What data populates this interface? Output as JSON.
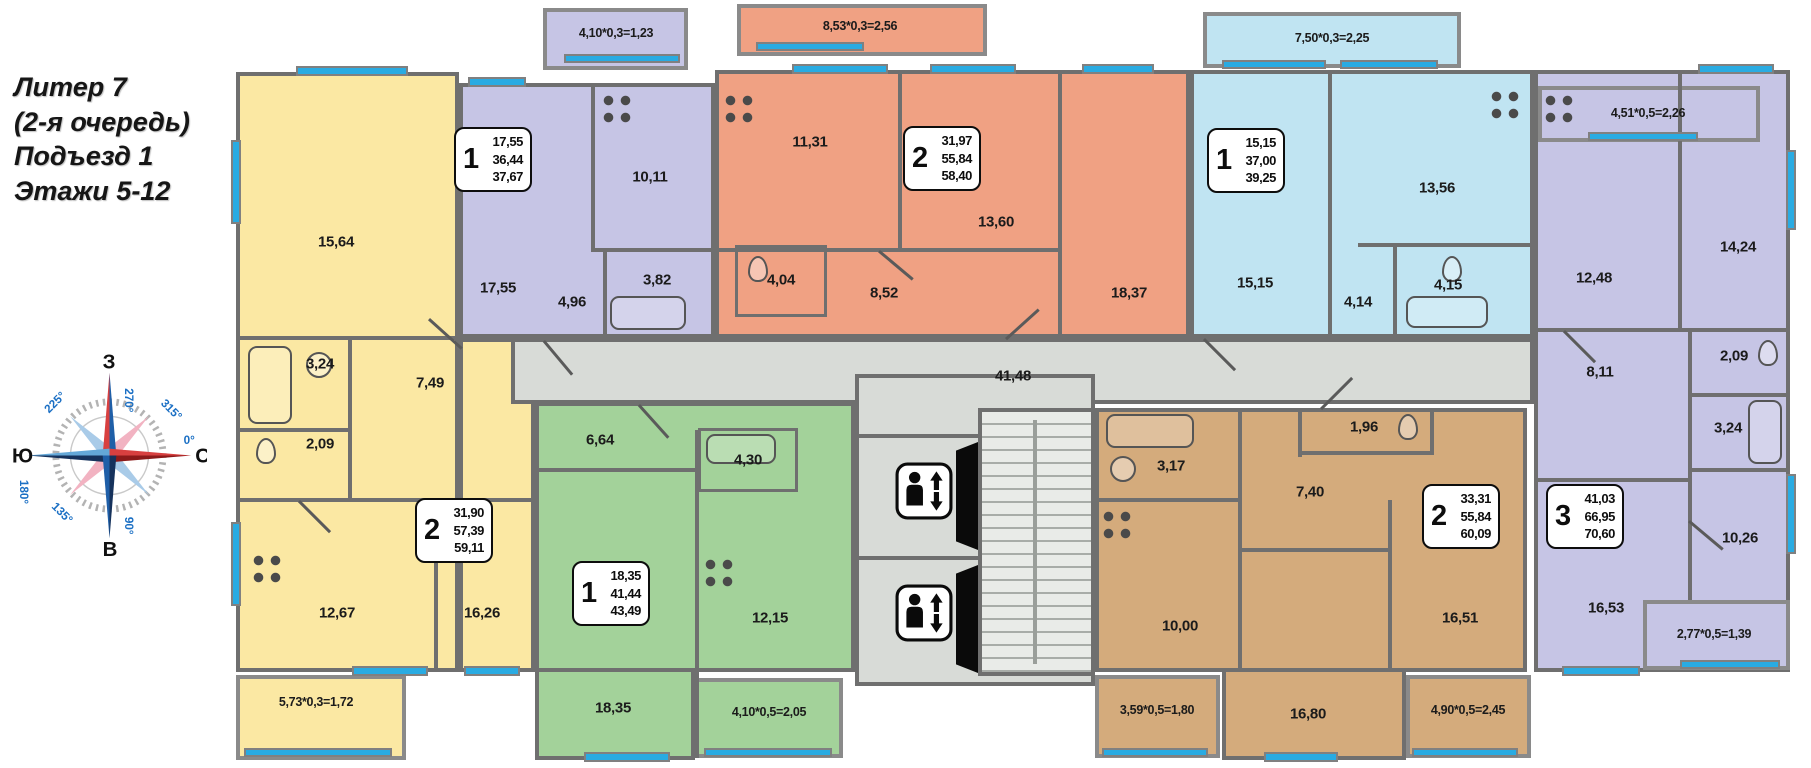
{
  "header": {
    "title_lines": [
      "Литер 7",
      "(2-я очередь)",
      "Подъезд 1",
      "Этажи 5-12"
    ]
  },
  "compass": {
    "west": "З",
    "north": "С",
    "south": "Ю",
    "east": "В",
    "deg_top": "270°",
    "deg_upper_right": "315°",
    "deg_right": "0°",
    "deg_bottom": "90°",
    "deg_left": "180°",
    "deg_upper_left": "225°",
    "deg_lower_left": "135°"
  },
  "corridor": {
    "area": "41,48"
  },
  "colors": {
    "yellow": "#FBE8A3",
    "lavender": "#C6C5E5",
    "orange": "#F0A183",
    "light_blue": "#C0E4F2",
    "green": "#A3D29A",
    "brown": "#D4AB7C",
    "corridor_gray": "#D8DBD7",
    "wall": "#6F6F6F",
    "window_blue": "#29ABE2"
  },
  "apartments": [
    {
      "name": "apartment-yellow",
      "type": "2",
      "areas": [
        "31,90",
        "57,39",
        "59,11"
      ],
      "rooms": {
        "room1": "15,64",
        "bath": "3,24",
        "wc": "2,09",
        "hall": "7,49",
        "kitchen": "12,67",
        "room2": "16,26"
      },
      "balcony1": "5,73*0,3=1,72"
    },
    {
      "name": "apartment-lavender",
      "type": "1",
      "areas": [
        "17,55",
        "36,44",
        "37,67"
      ],
      "rooms": {
        "room1": "17,55",
        "kitchen": "10,11",
        "hall": "4,96",
        "bath": "3,82"
      },
      "balcony1": "4,10*0,3=1,23"
    },
    {
      "name": "apartment-orange",
      "type": "2",
      "areas": [
        "31,97",
        "55,84",
        "58,40"
      ],
      "rooms": {
        "kitchen": "11,31",
        "room1": "13,60",
        "room2": "18,37",
        "hall": "8,52",
        "bath": "4,04"
      },
      "balcony1": "8,53*0,3=2,56"
    },
    {
      "name": "apartment-blue",
      "type": "1",
      "areas": [
        "15,15",
        "37,00",
        "39,25"
      ],
      "rooms": {
        "room1": "15,15",
        "kitchen": "13,56",
        "bath": "4,15",
        "hall": "4,14"
      },
      "balcony1": "7,50*0,3=2,25"
    },
    {
      "name": "apartment-green",
      "type": "1",
      "areas": [
        "18,35",
        "41,44",
        "43,49"
      ],
      "rooms": {
        "hall": "6,64",
        "bath": "4,30",
        "kitchen": "12,15",
        "room1": "18,35"
      },
      "balcony1": "4,10*0,5=2,05"
    },
    {
      "name": "apartment-brown",
      "type": "2",
      "areas": [
        "33,31",
        "55,84",
        "60,09"
      ],
      "rooms": {
        "bath": "3,17",
        "wc": "1,96",
        "hall": "7,40",
        "kitchen": "10,00",
        "room1": "16,51",
        "room2": "16,80"
      },
      "balcony1": "3,59*0,5=1,80",
      "balcony2": "4,90*0,5=2,45"
    },
    {
      "name": "apartment-purple",
      "type": "3",
      "areas": [
        "41,03",
        "66,95",
        "70,60"
      ],
      "rooms": {
        "kitchen": "12,48",
        "room1": "14,24",
        "wc": "2,09",
        "bath": "3,24",
        "hall": "8,11",
        "room2": "10,26",
        "room3": "16,53"
      },
      "balcony1": "4,51*0,5=2,26",
      "balcony2": "2,77*0,5=1,39"
    }
  ]
}
